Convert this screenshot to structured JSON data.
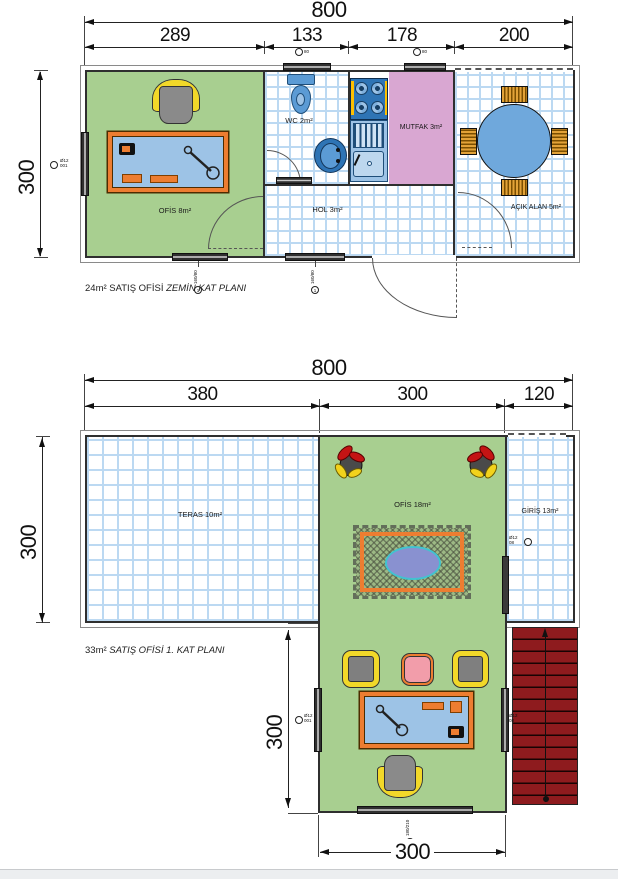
{
  "ground": {
    "dim_total": "800",
    "seg_1": "289",
    "seg_2": "133",
    "seg_3": "178",
    "seg_4": "200",
    "dim_height": "300",
    "room_ofis": "OFİS 8m²",
    "room_wc": "WC 2m²",
    "room_mutfak": "MUTFAK 3m²",
    "room_hol": "HOL 3m²",
    "room_acik": "AÇIK ALAN 5m²",
    "caption_normal": "24m² SATIŞ OFİSİ ",
    "caption_italic": "ZEMİN KAT PLANI",
    "tag_left_top": "Ø12",
    "tag_left_bottom": "001",
    "tag_top_wc": "80",
    "tag_top_mutfak": "80",
    "tag_win": "160/80",
    "tag_circle": "1"
  },
  "first": {
    "dim_total": "800",
    "seg_1": "380",
    "seg_2": "300",
    "seg_3": "120",
    "dim_height": "300",
    "dim_inner": "300",
    "dim_bottom": "300",
    "room_teras": "TERAS 10m²",
    "room_ofis": "OFİS 18m²",
    "room_giris": "GİRİŞ 13m²",
    "caption_normal": "33m² ",
    "caption_italic": "SATIŞ OFİSİ 1. KAT PLANI",
    "tag_giris_top": "Ø12",
    "tag_giris_bottom": "08",
    "tag_left_top": "Ø12",
    "tag_left_bottom": "001",
    "tag_right_top": "Ø12",
    "tag_right_bottom": "08",
    "tag_door": "180/210",
    "tag_circle": "2"
  },
  "colors": {
    "wall_dark": "#2f2f2f",
    "room_green": "#a8cf90",
    "tile_blue": "#bcd9f2",
    "kitchen_pink": "#d9a7d2",
    "desk_blue": "#9dc3e6",
    "accent_orange": "#ed7d31",
    "chair_yellow": "#f2d829",
    "stair_red": "#8e1b1e",
    "table_blue": "#6fa8dc",
    "rug_purple": "#8991d0"
  }
}
